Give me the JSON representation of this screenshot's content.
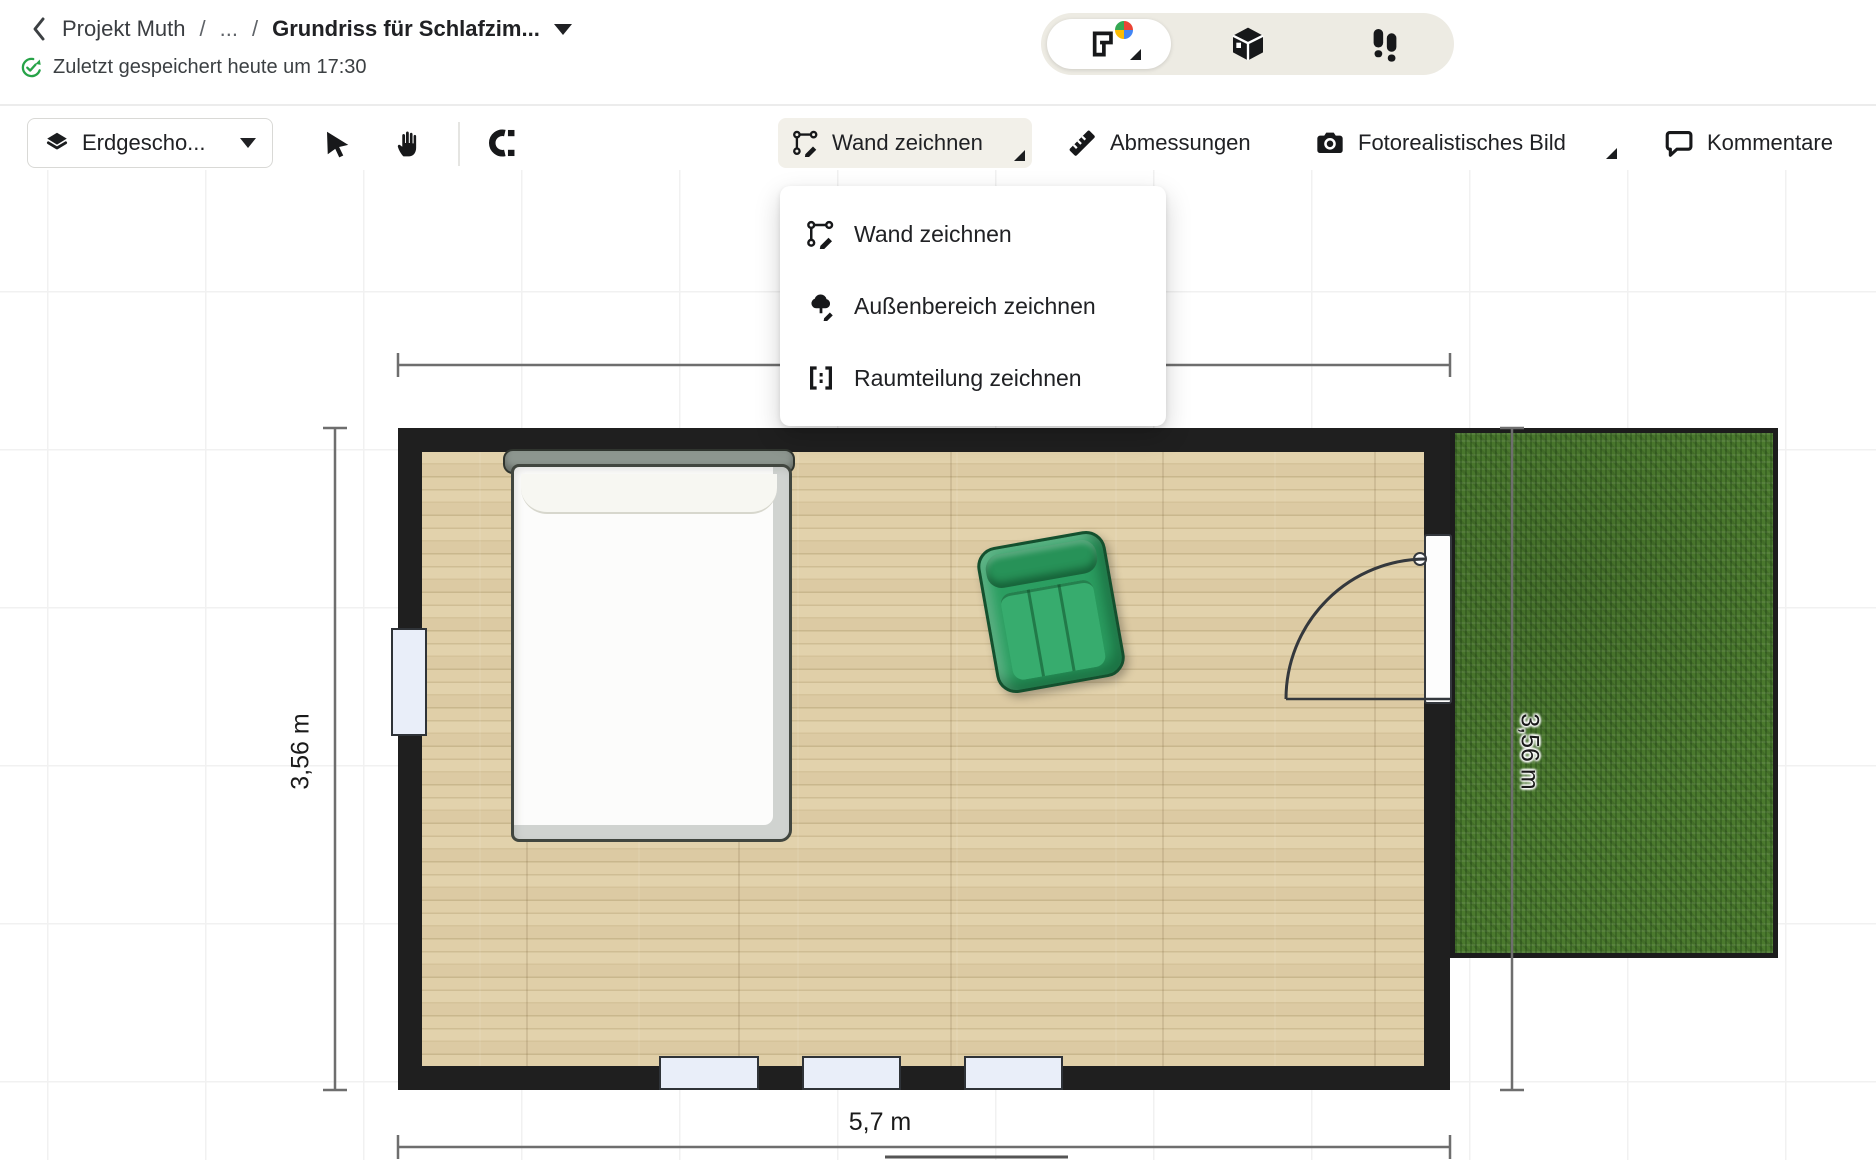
{
  "header": {
    "project": "Projekt Muth",
    "separator1": "/",
    "ellipsis": "...",
    "separator2": "/",
    "title": "Grundriss für Schlafzim...",
    "saved_status": "Zuletzt gespeichert heute um 17:30"
  },
  "view_switcher": {
    "segments": [
      {
        "icon": "floorplan-2d-icon",
        "selected": true
      },
      {
        "icon": "view-3d-icon",
        "selected": false
      },
      {
        "icon": "walkthrough-icon",
        "selected": false
      }
    ]
  },
  "toolbar": {
    "floor_select_label": "Erdgescho...",
    "wall_draw_label": "Wand zeichnen",
    "measurements_label": "Abmessungen",
    "photorealistic_label": "Fotorealistisches Bild",
    "comments_label": "Kommentare"
  },
  "wall_draw_menu": {
    "items": [
      {
        "label": "Wand zeichnen",
        "icon": "wall-draw-icon"
      },
      {
        "label": "Außenbereich zeichnen",
        "icon": "outdoor-area-draw-icon"
      },
      {
        "label": "Raumteilung zeichnen",
        "icon": "room-division-draw-icon"
      }
    ]
  },
  "floorplan": {
    "dim_left": "3,56 m",
    "dim_right": "3,56 m",
    "dim_bottom": "5,7 m",
    "objects": [
      "bed",
      "armchair",
      "door",
      "window-left",
      "window-bottom-1",
      "window-bottom-2",
      "window-bottom-3",
      "grass-area"
    ],
    "colors": {
      "wall": "#1f1f1f",
      "floor_wood": "#d9c7a0",
      "window_fill": "#e9eef9",
      "grass": "#4b7a2e",
      "dimension_line": "#6e6e6e",
      "chair_green": "#2b9e61",
      "saved_check_green": "#27a348"
    }
  }
}
